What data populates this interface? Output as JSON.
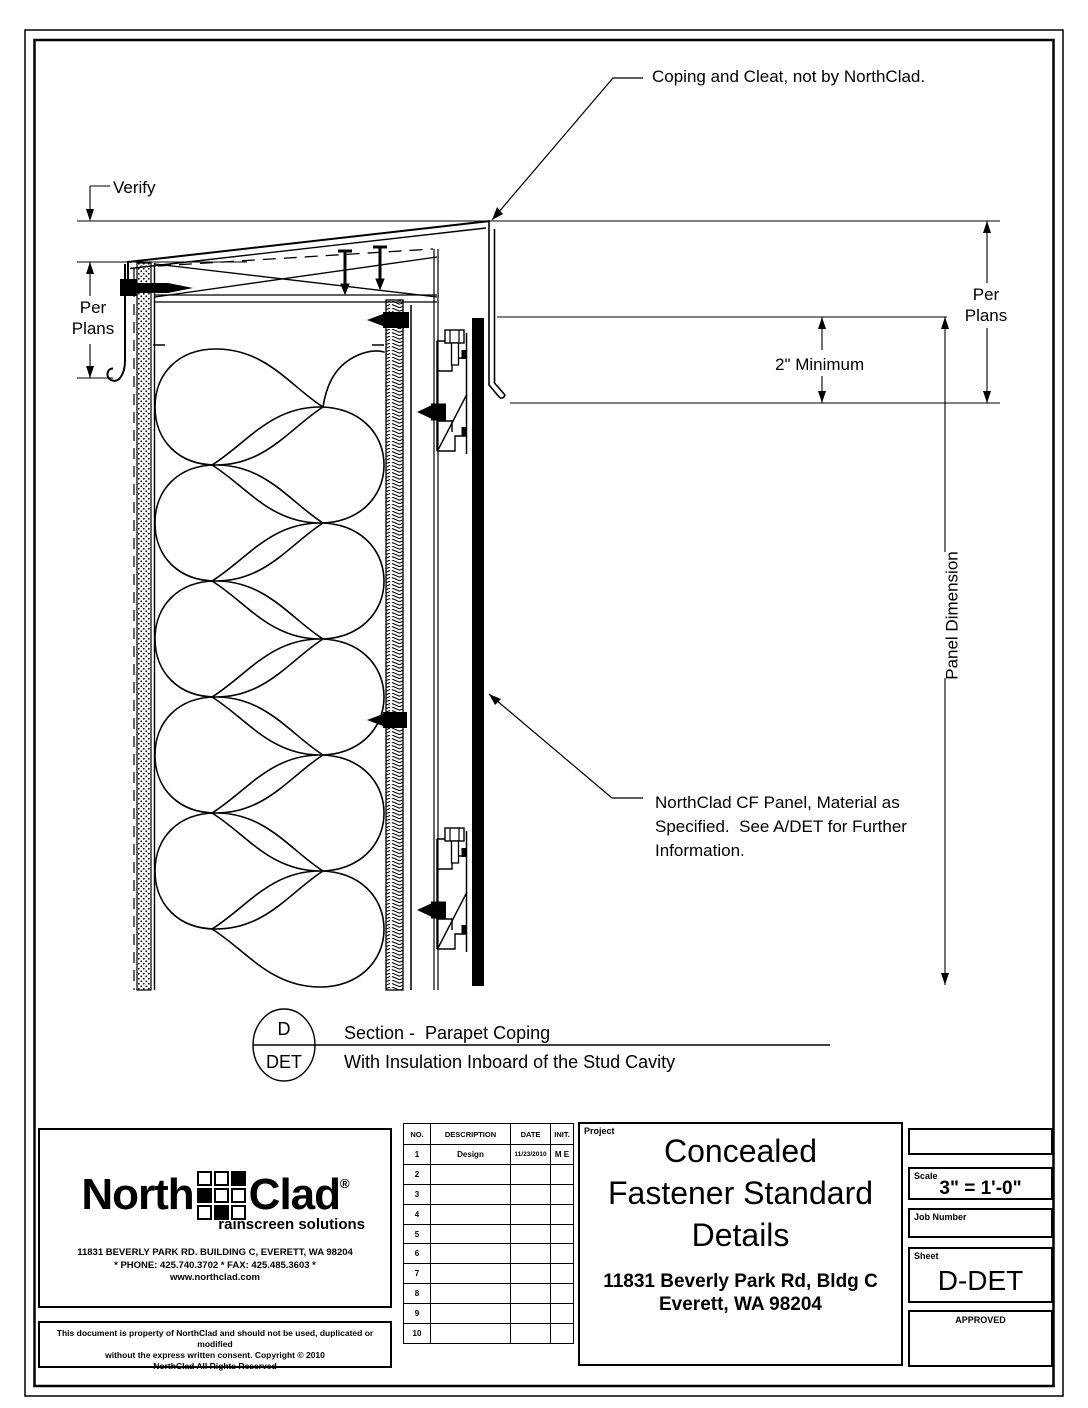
{
  "drawing": {
    "annotations": {
      "coping_note": "Coping and Cleat, not by NorthClad.",
      "verify": "Verify",
      "per_plans_left": {
        "line1": "Per",
        "line2": "Plans"
      },
      "per_plans_right": {
        "line1": "Per",
        "line2": "Plans"
      },
      "two_inch_minimum": "2\" Minimum",
      "panel_dimension": "Panel Dimension",
      "cf_panel_note_line1": "NorthClad CF Panel, Material as",
      "cf_panel_note_line2": "Specified.  See A/DET for Further",
      "cf_panel_note_line3": "Information."
    },
    "section_marker": {
      "detail_letter": "D",
      "sheet_ref": "DET",
      "title": "Section -  Parapet Coping",
      "subtitle": "With Insulation Inboard of the Stud Cavity"
    }
  },
  "title_block": {
    "logo": {
      "brand_north": "North",
      "brand_clad": "Clad",
      "registered": "®",
      "tagline": "rainscreen solutions",
      "address": "11831 BEVERLY PARK RD. BUILDING C, EVERETT, WA 98204",
      "phone_fax": "* PHONE: 425.740.3702 * FAX: 425.485.3603 *",
      "website": "www.northclad.com"
    },
    "copyright": {
      "line1": "This document is property of NorthClad and should not be used, duplicated or modified",
      "line2": "without the express written consent.  Copyright © 2010",
      "line3": "NorthClad All Rights Reserved"
    },
    "revision_table": {
      "headers": [
        "NO.",
        "DESCRIPTION",
        "DATE",
        "INIT."
      ],
      "rows": [
        {
          "no": "1",
          "description": "Design",
          "date": "11/23/2010",
          "init": "M E"
        },
        {
          "no": "2",
          "description": "",
          "date": "",
          "init": ""
        },
        {
          "no": "3",
          "description": "",
          "date": "",
          "init": ""
        },
        {
          "no": "4",
          "description": "",
          "date": "",
          "init": ""
        },
        {
          "no": "5",
          "description": "",
          "date": "",
          "init": ""
        },
        {
          "no": "6",
          "description": "",
          "date": "",
          "init": ""
        },
        {
          "no": "7",
          "description": "",
          "date": "",
          "init": ""
        },
        {
          "no": "8",
          "description": "",
          "date": "",
          "init": ""
        },
        {
          "no": "9",
          "description": "",
          "date": "",
          "init": ""
        },
        {
          "no": "10",
          "description": "",
          "date": "",
          "init": ""
        }
      ]
    },
    "project": {
      "label": "Project",
      "title_line1": "Concealed",
      "title_line2": "Fastener Standard",
      "title_line3": "Details",
      "address_line1": "11831 Beverly Park Rd, Bldg C",
      "address_line2": "Everett, WA 98204"
    },
    "stamp": {
      "scale_label": "Scale",
      "scale_value": "3\" = 1'-0\"",
      "job_number_label": "Job Number",
      "sheet_label": "Sheet",
      "sheet_value": "D-DET",
      "approved_label": "APPROVED"
    }
  }
}
